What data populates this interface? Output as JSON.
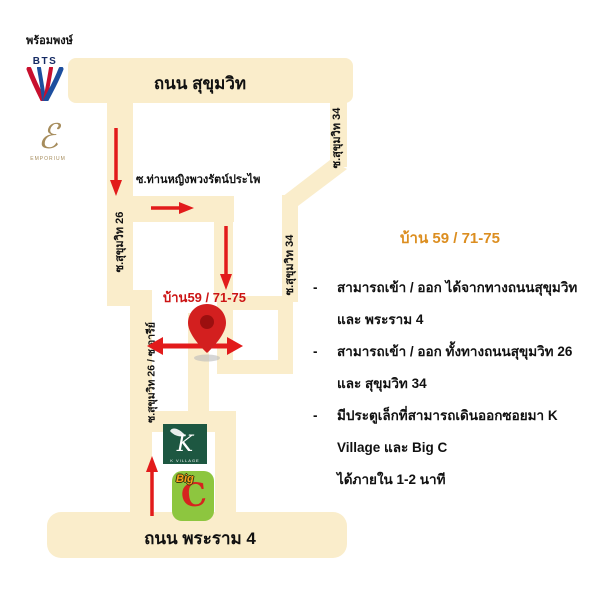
{
  "station": {
    "name": "พร้อมพงษ์",
    "bts_word": "BTS"
  },
  "roads": {
    "sukhumvit": "ถนน สุขุมวิท",
    "rama4": "ถนน พระราม 4",
    "soi26": "ซ.สุขุมวิท 26",
    "soi26_aree": "ซ.สุขุมวิท 26 / ซ.อารีย์",
    "soi34_upper": "ซ.สุขุมวิท 34",
    "soi34_lower": "ซ.สุขุมวิท 34",
    "thanying": "ซ.ท่านหญิงพวงรัตน์ประไพ"
  },
  "map_labels": {
    "house": "บ้าน59 / 71-75"
  },
  "info": {
    "title": "บ้าน 59 / 71-75",
    "bullet_dash": "-",
    "bullets": [
      {
        "line1": "สามารถเข้า / ออก ได้จากทางถนนสุขุมวิท และ พระราม 4",
        "line2": ""
      },
      {
        "line1": "สามารถเข้า / ออก ทั้งทางถนนสุขุมวิท 26 และ สุขุมวิท 34",
        "line2": ""
      },
      {
        "line1": "มีประตูเล็กที่สามารถเดินออกซอยมา K Village และ Big C",
        "line2": "ได้ภายใน 1-2 นาที"
      }
    ]
  },
  "logos": {
    "emporium_mark": "ℰ",
    "emporium_word": "EMPORIUM",
    "kvillage_letter": "K",
    "kvillage_word": "K VILLAGE",
    "bigc_big": "Big",
    "bigc_c": "C"
  },
  "colors": {
    "road": "#FAEDCB",
    "arrow_red": "#E21B1B",
    "pin_red": "#D31F1F",
    "title_orange": "#DC8E20",
    "house_red": "#CC1414",
    "bts_navy": "#152A63",
    "bts_blue": "#1D4F9E",
    "bts_red": "#C8102E",
    "kvillage_green": "#1D5741",
    "bigc_green": "#8DC63F",
    "bigc_red": "#D6231F",
    "emporium_gold": "#A68C5C"
  }
}
